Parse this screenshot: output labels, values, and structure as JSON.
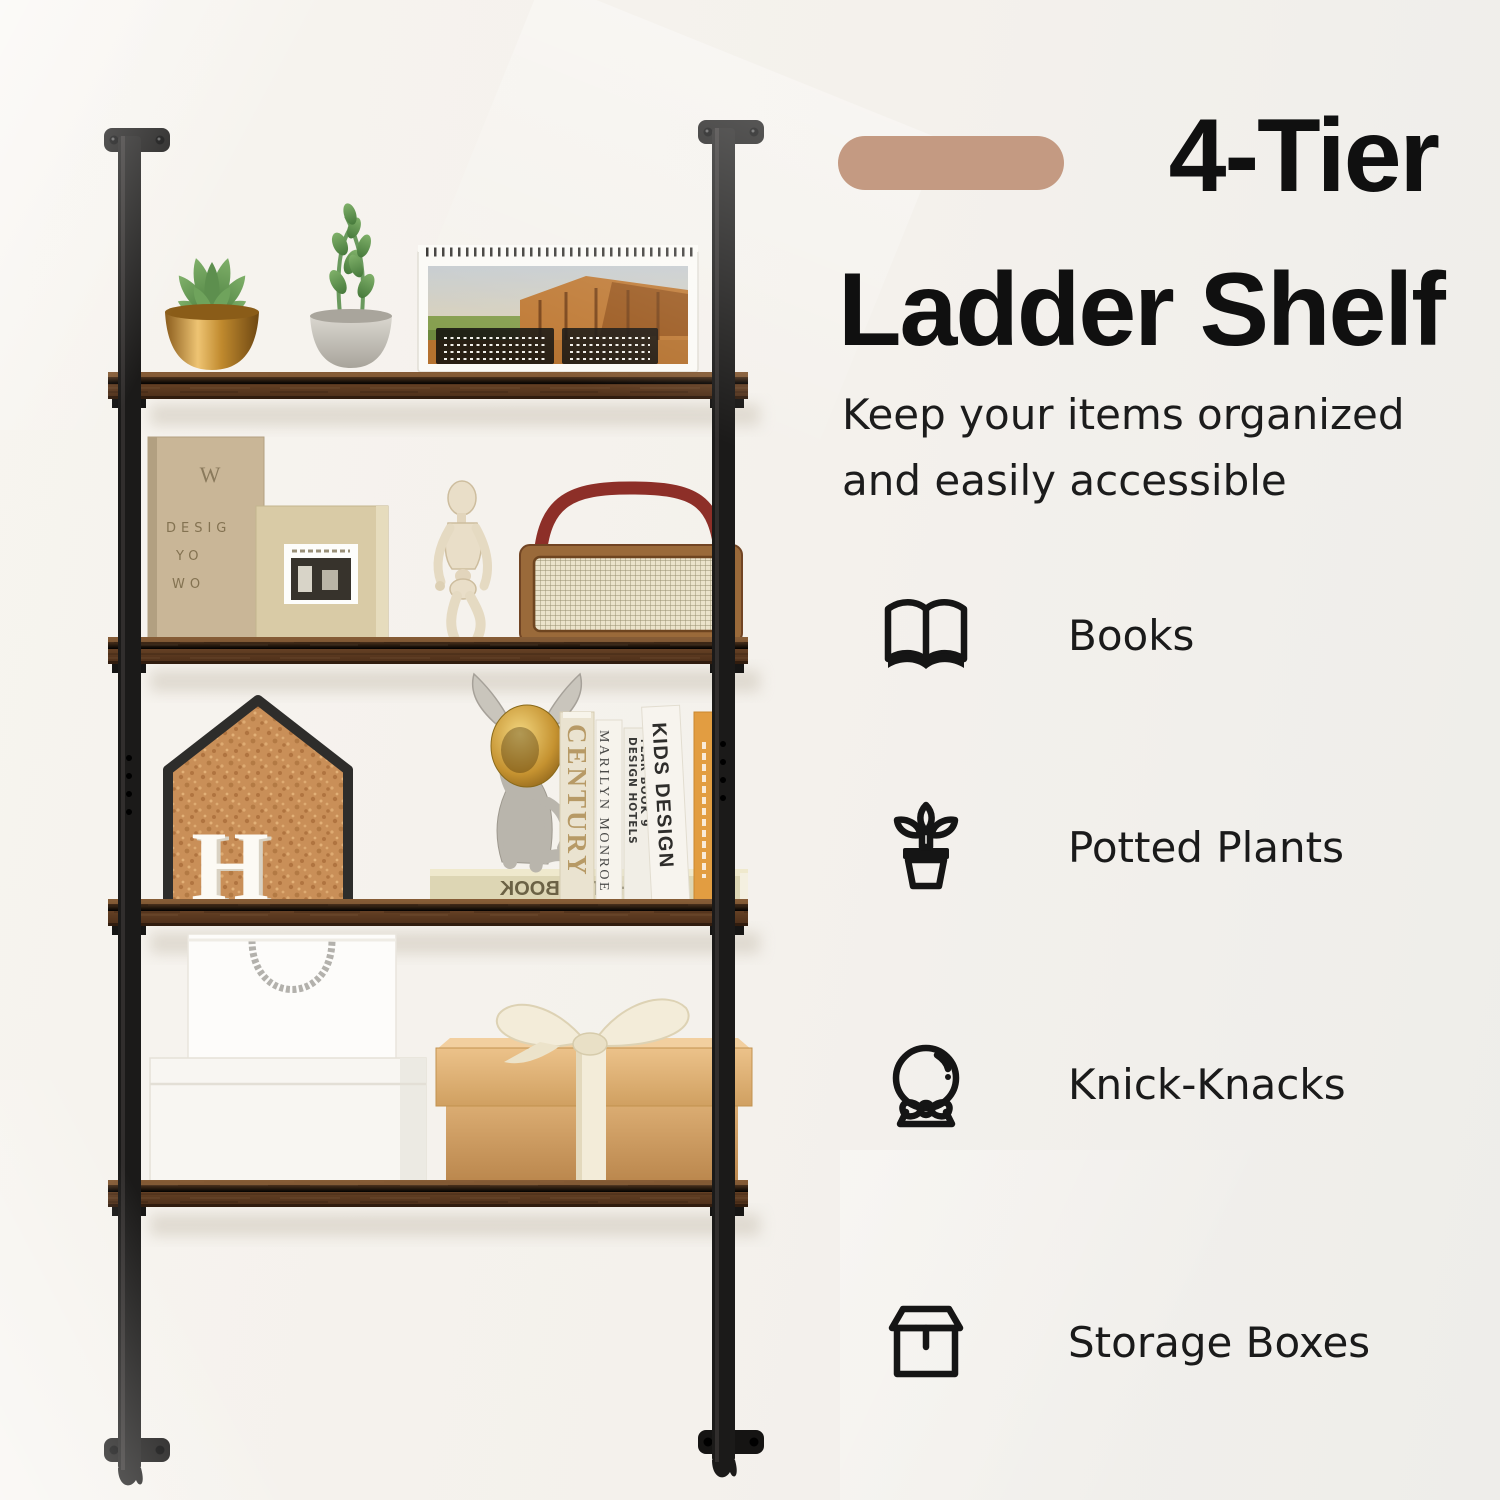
{
  "colors": {
    "bg-left": "#f7f4ef",
    "bg-right": "#eeedea",
    "accent-pill": "#c49a82",
    "title-text": "#101010",
    "body-text": "#1e1e1e",
    "icon-stroke": "#151515",
    "metal": "#1b1a18",
    "wood": "#6b4628",
    "wood-dark": "#47290f",
    "cork": "#c98f58",
    "kraft-box": "#d3a468",
    "ribbon": "#f3ecd9",
    "radio-handle-red": "#8d2f28"
  },
  "title": {
    "line1": "4-Tier",
    "line2": "Ladder Shelf"
  },
  "subtitle": {
    "line1": "Keep your items organized",
    "line2": "and easily accessible"
  },
  "features": [
    {
      "icon": "open-book-icon",
      "label": "Books"
    },
    {
      "icon": "potted-plant-icon",
      "label": "Potted Plants"
    },
    {
      "icon": "snow-globe-icon",
      "label": "Knick-Knacks"
    },
    {
      "icon": "storage-box-icon",
      "label": "Storage Boxes"
    }
  ],
  "photo": {
    "linen_book": {
      "monogram": "W",
      "line1": "DESIG",
      "line2": "YO",
      "line3": "WO"
    },
    "letter_decor": "H",
    "lying_book_title": "THE HOTEL BOOK",
    "spines": {
      "s1": "CENTURY",
      "s2": "MARILYN MONROE",
      "s3a": "DESIGN HOTELS",
      "s3b": "YEAR BOOK 9",
      "s4": "KIDS DESIGN"
    }
  }
}
